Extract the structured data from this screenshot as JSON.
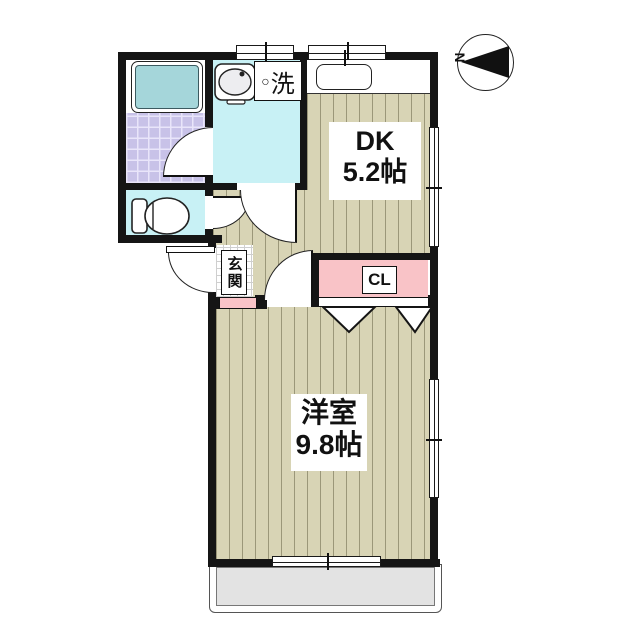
{
  "compass": {
    "north_label": "N"
  },
  "rooms": {
    "dk": {
      "name": "DK",
      "area": "5.2帖"
    },
    "western_room": {
      "name": "洋室",
      "area": "9.8帖"
    },
    "closet": {
      "label": "CL"
    },
    "entrance": {
      "label": "玄関"
    },
    "laundry": {
      "marker": "○",
      "label": "洗"
    }
  },
  "colors": {
    "wall": "#151515",
    "flooring": "#d8d4b5",
    "flooring_stripe": "#9b9779",
    "wet_area_floor": "#c8f1f5",
    "bathtub": "#a5d6da",
    "bath_tile": "#c8c2e8",
    "closet_fill": "#f9c3c7",
    "entrance_step": "#f9c3c7",
    "balcony": "#e3e3e3"
  }
}
